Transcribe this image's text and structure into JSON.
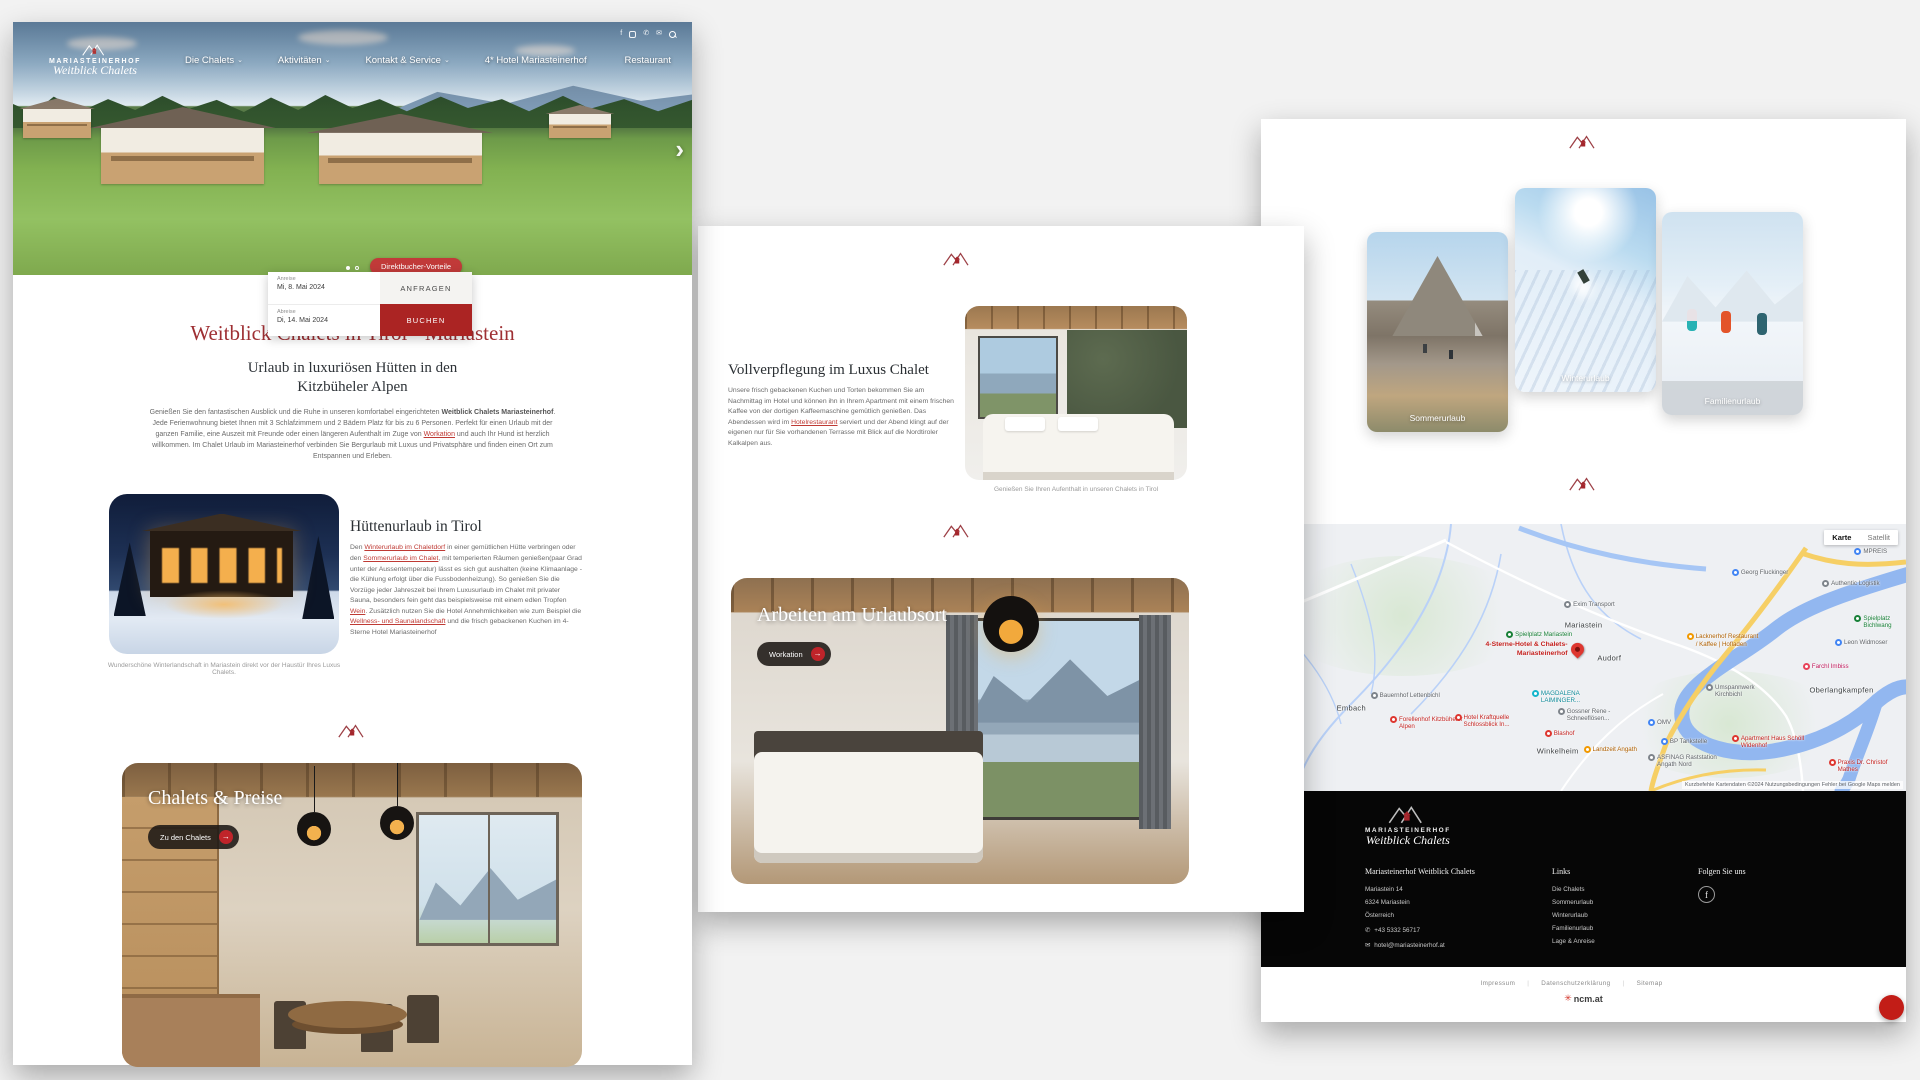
{
  "brand": {
    "name": "MARIASTEINERHOF",
    "script": "Weitblick Chalets"
  },
  "accent": "#9e2f33",
  "left_page": {
    "nav": {
      "items": [
        {
          "label": "Die Chalets",
          "chev": "⌄"
        },
        {
          "label": "Aktivitäten",
          "chev": "⌄"
        },
        {
          "label": "Kontakt & Service",
          "chev": "⌄"
        },
        {
          "label": "4* Hotel Mariasteinerhof",
          "chev": ""
        },
        {
          "label": "Restaurant",
          "chev": ""
        }
      ]
    },
    "hero": {
      "direktbucher": "Direktbucher-Vorteile",
      "next_arrow": "›",
      "booking": {
        "anreise_label": "Anreise",
        "anreise_value": "Mi, 8. Mai 2024",
        "abreise_label": "Abreise",
        "abreise_value": "Di, 14. Mai 2024",
        "anfragen": "ANFRAGEN",
        "buchen": "BUCHEN"
      }
    },
    "title": "Weitblick Chalets in Tirol - Mariastein",
    "subtitle": "Urlaub in luxuriösen Hütten in den Kitzbüheler Alpen",
    "intro": [
      {
        "t": "Genießen Sie den fantastischen Ausblick und die Ruhe in unseren komfortabel eingerichteten "
      },
      {
        "t": "Weitblick Chalets Mariasteinerhof",
        "s": "b"
      },
      {
        "t": ". Jede Ferienwohnung bietet Ihnen mit 3 Schlafzimmern und 2 Bädern Platz für bis zu 6 Personen. Perfekt für einen Urlaub mit der ganzen Familie, eine Auszeit mit Freunde oder einen längeren Aufenthalt im Zuge von "
      },
      {
        "t": "Workation",
        "s": "a"
      },
      {
        "t": " und auch Ihr Hund ist herzlich willkommen. Im Chalet Urlaub im Mariasteinerhof verbinden Sie Bergurlaub mit Luxus und Privatsphäre und finden einen Ort zum Entspannen und Erleben."
      }
    ],
    "huette": {
      "title": "Hüttenurlaub in Tirol",
      "body": [
        {
          "t": "Den "
        },
        {
          "t": "Winterurlaub im Chaletdorf",
          "s": "a"
        },
        {
          "t": " in einer gemütlichen Hütte verbringen oder den "
        },
        {
          "t": "Sommerurlaub im Chalet",
          "s": "a"
        },
        {
          "t": ", mit temperierten Räumen genießen(paar Grad unter der Aussentemperatur) lässt es sich gut aushalten (keine Klimaanlage - die Kühlung erfolgt über die Fussbodenheizung). So genießen Sie die Vorzüge jeder Jahreszeit bei Ihrem Luxusurlaub im Chalet mit privater Sauna, besonders fein geht das beispielsweise mit einem edlen Tropfen "
        },
        {
          "t": "Wein",
          "s": "a"
        },
        {
          "t": ". Zusätzlich nutzen Sie die Hotel Annehmlichkeiten wie zum Beispiel die "
        },
        {
          "t": "Wellness- und Saunalandschaft",
          "s": "a"
        },
        {
          "t": " und die frisch gebackenen Kuchen im 4-Sterne Hotel Mariasteinerhof"
        }
      ],
      "caption": "Wunderschöne Winterlandschaft in Mariastein direkt vor der Haustür Ihres Luxus Chalets."
    },
    "preise": {
      "title": "Chalets & Preise",
      "button": "Zu den Chalets",
      "arrow": "→"
    }
  },
  "middle_page": {
    "voll": {
      "title": "Vollverpflegung im Luxus Chalet",
      "body": [
        {
          "t": "Unsere frisch gebackenen Kuchen und Torten bekommen Sie am Nachmittag im Hotel und können ihn in Ihrem Apartment mit einem frischen Kaffee von der dortigen Kaffeemaschine gemütlich genießen. Das Abendessen wird im "
        },
        {
          "t": "Hotelrestaurant",
          "s": "a"
        },
        {
          "t": " serviert und der Abend klingt auf der eigenen nur für Sie vorhandenen Terrasse mit Blick auf die Nordtiroler Kalkalpen aus."
        }
      ],
      "caption": "Genießen Sie Ihren Aufenthalt in unseren Chalets in Tirol"
    },
    "workation": {
      "title": "Arbeiten am Urlaubsort",
      "button": "Workation",
      "arrow": "→"
    }
  },
  "right_page": {
    "cards": [
      {
        "label": "Sommerurlaub",
        "variant": "summer"
      },
      {
        "label": "Winterurlaub",
        "variant": "winter"
      },
      {
        "label": "Familienurlaub",
        "variant": "family"
      }
    ],
    "map": {
      "controls": {
        "karte": "Karte",
        "satellit": "Satellit"
      },
      "attribution": "Kurzbefehle   Kartendaten ©2024   Nutzungsbedingungen   Fehler bei Google Maps melden",
      "main_poi": {
        "label": "4-Sterne-Hotel & Chalets-Mariasteinerhof"
      },
      "towns": [
        {
          "label": "Mariastein",
          "x": "50%",
          "y": "38%"
        },
        {
          "label": "Audorf",
          "x": "54%",
          "y": "50%"
        },
        {
          "label": "Embach",
          "x": "14%",
          "y": "69%"
        },
        {
          "label": "Winkelheim",
          "x": "46%",
          "y": "85%"
        },
        {
          "label": "Oberlangkampfen",
          "x": "90%",
          "y": "62%"
        }
      ],
      "pois": [
        {
          "label": "Exim Transport",
          "x": "47%",
          "y": "29%",
          "c": "gray"
        },
        {
          "label": "Spielplatz Mariastein",
          "x": "38%",
          "y": "40%",
          "c": "green"
        },
        {
          "label": "Bauernhof Lettenbichl",
          "x": "17%",
          "y": "63%",
          "c": "gray"
        },
        {
          "label": "Forellenhof Kitzbüheler Alpen",
          "x": "20%",
          "y": "72%",
          "c": "red"
        },
        {
          "label": "Hotel Kraftquelle Schlossblick In...",
          "x": "30%",
          "y": "71%",
          "c": "red"
        },
        {
          "label": "MAGDALENA LAIMINGER...",
          "x": "42%",
          "y": "62%",
          "c": "teal"
        },
        {
          "label": "Gossner Rene - Schneeflösen...",
          "x": "46%",
          "y": "69%",
          "c": "gray"
        },
        {
          "label": "Blashof",
          "x": "44%",
          "y": "77%",
          "c": "red"
        },
        {
          "label": "Georg Fluckinger",
          "x": "73%",
          "y": "17%",
          "c": "blue"
        },
        {
          "label": "Authentic Logistik",
          "x": "87%",
          "y": "21%",
          "c": "gray"
        },
        {
          "label": "MPREIS",
          "x": "92%",
          "y": "9%",
          "c": "blue"
        },
        {
          "label": "Lacknerhof Restaurant / Kaffee | Hofladen",
          "x": "66%",
          "y": "41%",
          "c": "orange"
        },
        {
          "label": "Spielplatz Bichlwang",
          "x": "92%",
          "y": "34%",
          "c": "green"
        },
        {
          "label": "Leon Widmoser",
          "x": "89%",
          "y": "43%",
          "c": "blue"
        },
        {
          "label": "Farchl Imbiss",
          "x": "84%",
          "y": "52%",
          "c": "pink"
        },
        {
          "label": "Umspannwerk Kirchbichl",
          "x": "69%",
          "y": "60%",
          "c": "gray"
        },
        {
          "label": "OMV",
          "x": "60%",
          "y": "73%",
          "c": "blue"
        },
        {
          "label": "BP Tankstelle",
          "x": "62%",
          "y": "80%",
          "c": "blue"
        },
        {
          "label": "Landzeit Angath",
          "x": "50%",
          "y": "83%",
          "c": "orange"
        },
        {
          "label": "ASFINAG Raststation Angath Nord",
          "x": "60%",
          "y": "86%",
          "c": "gray"
        },
        {
          "label": "Apartment Haus Schöll Widenhof",
          "x": "73%",
          "y": "79%",
          "c": "red"
        },
        {
          "label": "Praxis Dr. Christof Mathes",
          "x": "88%",
          "y": "88%",
          "c": "red"
        }
      ]
    },
    "footer": {
      "address_title": "Mariasteinerhof Weitblick Chalets",
      "address_lines": [
        {
          "label": "Mariastein 14"
        },
        {
          "label": "6324 Mariastein"
        },
        {
          "label": "Österreich"
        }
      ],
      "phone": "+43 5332 56717",
      "email": "hotel@mariasteinerhof.at",
      "links_title": "Links",
      "links": [
        {
          "label": "Die Chalets"
        },
        {
          "label": "Sommerurlaub"
        },
        {
          "label": "Winterurlaub"
        },
        {
          "label": "Familienurlaub"
        },
        {
          "label": "Lage & Anreise"
        }
      ],
      "follow_title": "Folgen Sie uns"
    },
    "bottom": {
      "links": [
        {
          "label": "Impressum"
        },
        {
          "label": "Datenschutzerklärung"
        },
        {
          "label": "Sitemap"
        }
      ],
      "agency": "ncm.at"
    }
  }
}
